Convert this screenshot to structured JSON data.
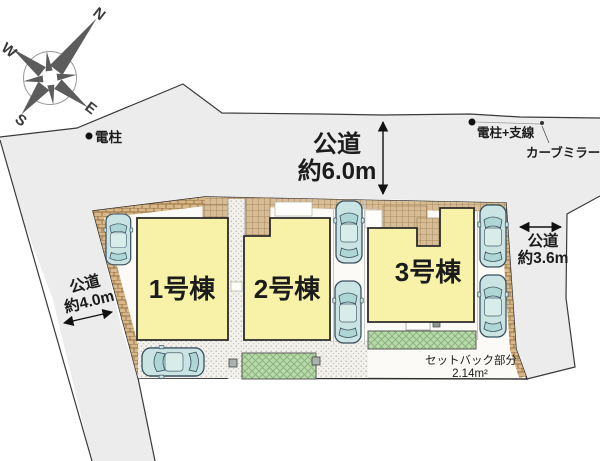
{
  "plan": {
    "compass": {
      "n": "N",
      "e": "E",
      "s": "S",
      "w": "W"
    },
    "roads": {
      "top": {
        "name": "公道",
        "width": "約6.0m"
      },
      "left": {
        "name": "公道",
        "width": "約4.0m"
      },
      "right": {
        "name": "公道",
        "width": "約3.6m"
      }
    },
    "buildings": [
      {
        "label": "1号棟"
      },
      {
        "label": "2号棟"
      },
      {
        "label": "3号棟"
      }
    ],
    "annotations": {
      "pole": "電柱",
      "pole_wire": "電柱+支線",
      "curve_mirror": "カーブミラー",
      "setback_line1": "セットバック部分",
      "setback_line2": "2.14m²"
    },
    "colors": {
      "road": "#ececec",
      "plot": "#fbfaf6",
      "building": "#f7f2a8",
      "hatch_brick": "#d8b88a",
      "hatch_tile": "#d7bd96",
      "green": "#b9d9ab",
      "car": "#c9e4e2"
    }
  }
}
